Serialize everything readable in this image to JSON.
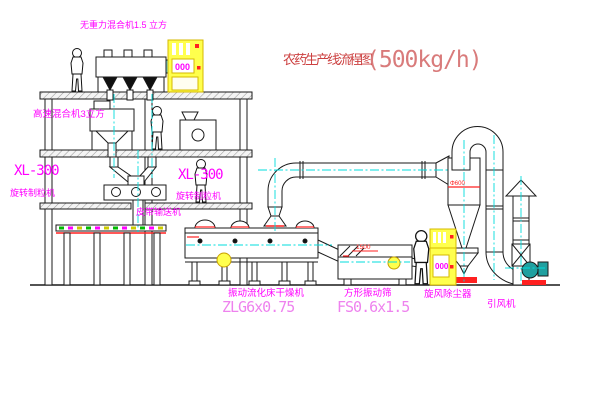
{
  "diagram": {
    "title": "农药生产线流程图",
    "capacity": "(500kg/h)"
  },
  "equipment_labels": {
    "zero_gravity_mixer": "无重力混合机1.5 立方",
    "high_speed_mixer": "高速混合机3立方",
    "granulator_left": {
      "model": "XL-300",
      "name": "旋转制粒机"
    },
    "granulator_right": {
      "model": "XL-300",
      "name": "旋转制粒机"
    },
    "belt_conveyor": "皮带输送机",
    "fluid_bed_dryer": {
      "name": "振动流化床干燥机",
      "model": "ZLG6x0.75"
    },
    "square_sieve": {
      "name": "方形振动筛",
      "model": "FS0.6x1.5"
    },
    "cyclone": "旋风除尘器",
    "induced_draft_fan": "引风机"
  },
  "dimension_annotations": {
    "sieve_length": "1500",
    "cyclone_diameter": "Φ600"
  },
  "control_cabinets": {
    "cabinet1_display": "000",
    "cabinet2_display": "000"
  },
  "colors": {
    "centerline_cyan": "#00dcdc",
    "label_magenta": "#ff00ff",
    "model_pink": "#ee82ee",
    "title_red": "#cc4040",
    "capacity_red": "#d97b7b",
    "cabinet_yellow": "#ffff4d",
    "annotation_red": "#ff2020"
  }
}
